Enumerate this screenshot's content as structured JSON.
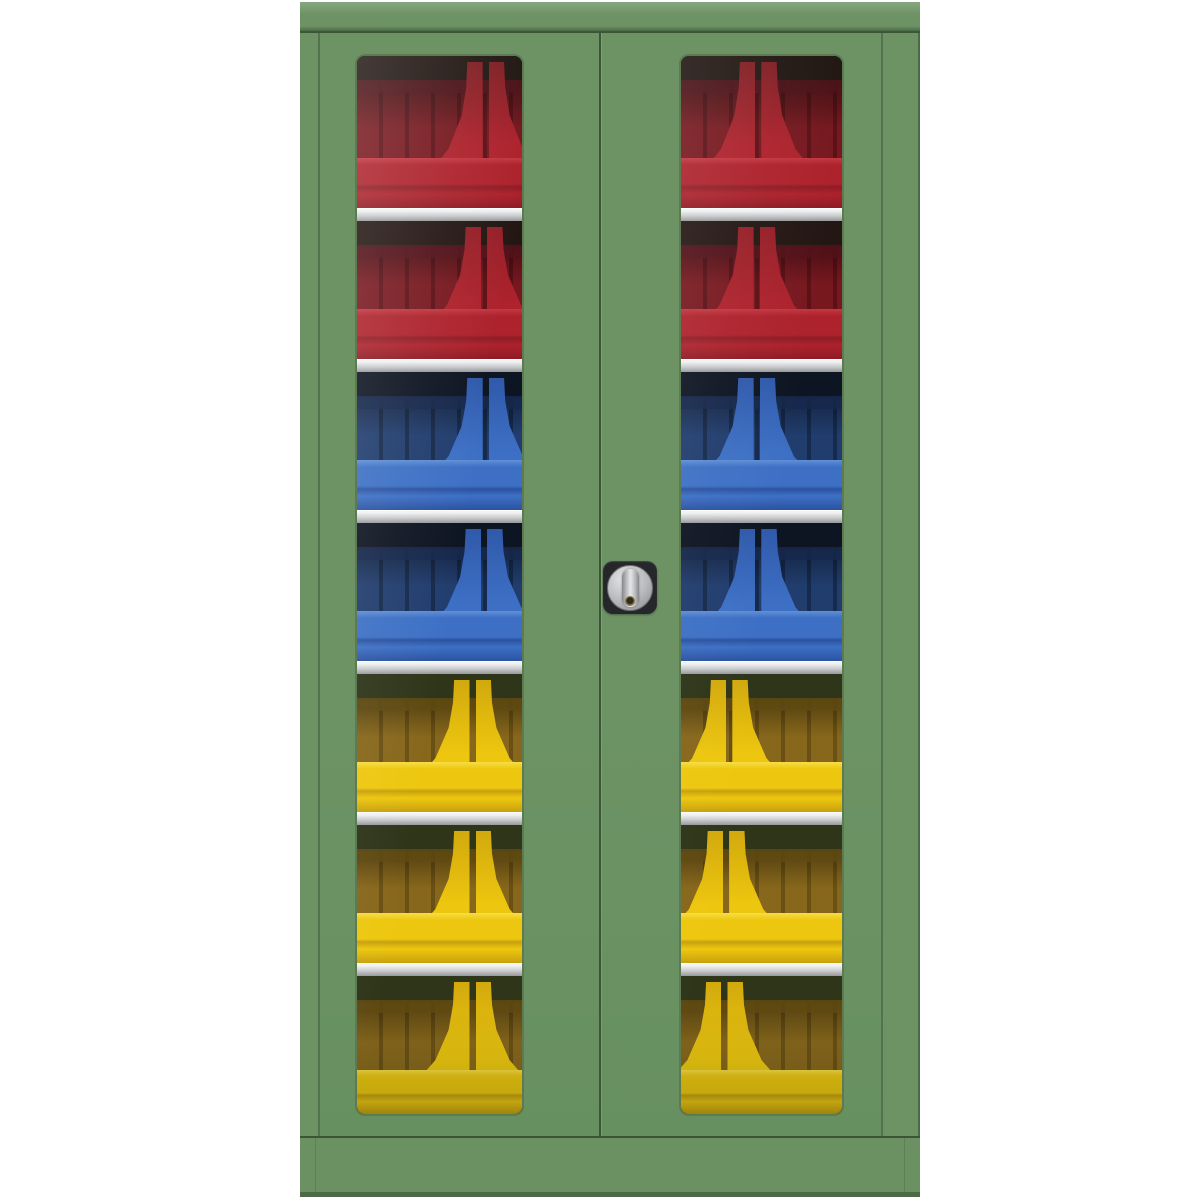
{
  "scene": {
    "type": "product-photo",
    "subject": "vision-panel double door storage cabinet with open fronted bins",
    "background_color": "#ffffff"
  },
  "palette": {
    "css_vars": {
      "bg": "#ffffff",
      "green": "#6d9365",
      "green-hi": "#84a67b",
      "green-lo": "#679060",
      "green-lo2": "#6b9062",
      "green-edge": "#4c6a46",
      "seam": "#3b5637",
      "seam-soft": "#54724d",
      "frame-dark": "#1c2618",
      "frame-bevel": "#5d7a53",
      "shelf-top": "#f2f3f4",
      "shelf-mid": "#c9cbcd",
      "shelf-bot": "#96989b",
      "plate": "#26272b",
      "knob-hi": "#e4e6e8",
      "knob-mid": "#b7b9bc",
      "knob-lo": "#85878a",
      "knob-edge": "#6e7073",
      "keyhole": "#9a8450"
    }
  },
  "cabinet": {
    "doors": 2,
    "shelves_visible": 6,
    "windows_per_door": 1,
    "lock": {
      "type": "rotary-knob-cylinder",
      "position": "right-door-center"
    },
    "bin_rows": [
      {
        "color": "red",
        "pillar_left_pct": 78,
        "pillar_right_pct": 48
      },
      {
        "color": "red",
        "pillar_left_pct": 77,
        "pillar_right_pct": 47
      },
      {
        "color": "blue",
        "pillar_left_pct": 78,
        "pillar_right_pct": 47
      },
      {
        "color": "blue",
        "pillar_left_pct": 77,
        "pillar_right_pct": 48
      },
      {
        "color": "yellow",
        "pillar_left_pct": 70,
        "pillar_right_pct": 30
      },
      {
        "color": "yellow",
        "pillar_left_pct": 70,
        "pillar_right_pct": 28
      },
      {
        "color": "yellow",
        "pillar_left_pct": 70,
        "pillar_right_pct": 27
      }
    ],
    "bin_palettes": {
      "red": {
        "dark": "#241613",
        "rim": "#54121a",
        "back": "#77181f",
        "backline": "#5c1016",
        "lip": "#ad222c",
        "lip_hi": "#c53741",
        "lip_shade": "#8e1b24",
        "mid": "#941f28"
      },
      "blue": {
        "dark": "#0e1522",
        "rim": "#16284c",
        "back": "#213d6e",
        "backline": "#152a4c",
        "lip": "#3d70c5",
        "lip_hi": "#6190d6",
        "lip_shade": "#2b52a0",
        "mid": "#3059aa"
      },
      "yellow": {
        "dark": "#2e3519",
        "rim": "#5f4a12",
        "back": "#87671b",
        "backline": "#6a5014",
        "lip": "#edc70f",
        "lip_hi": "#f7dd44",
        "lip_shade": "#c7a10d",
        "mid": "#d2a90e"
      }
    }
  }
}
